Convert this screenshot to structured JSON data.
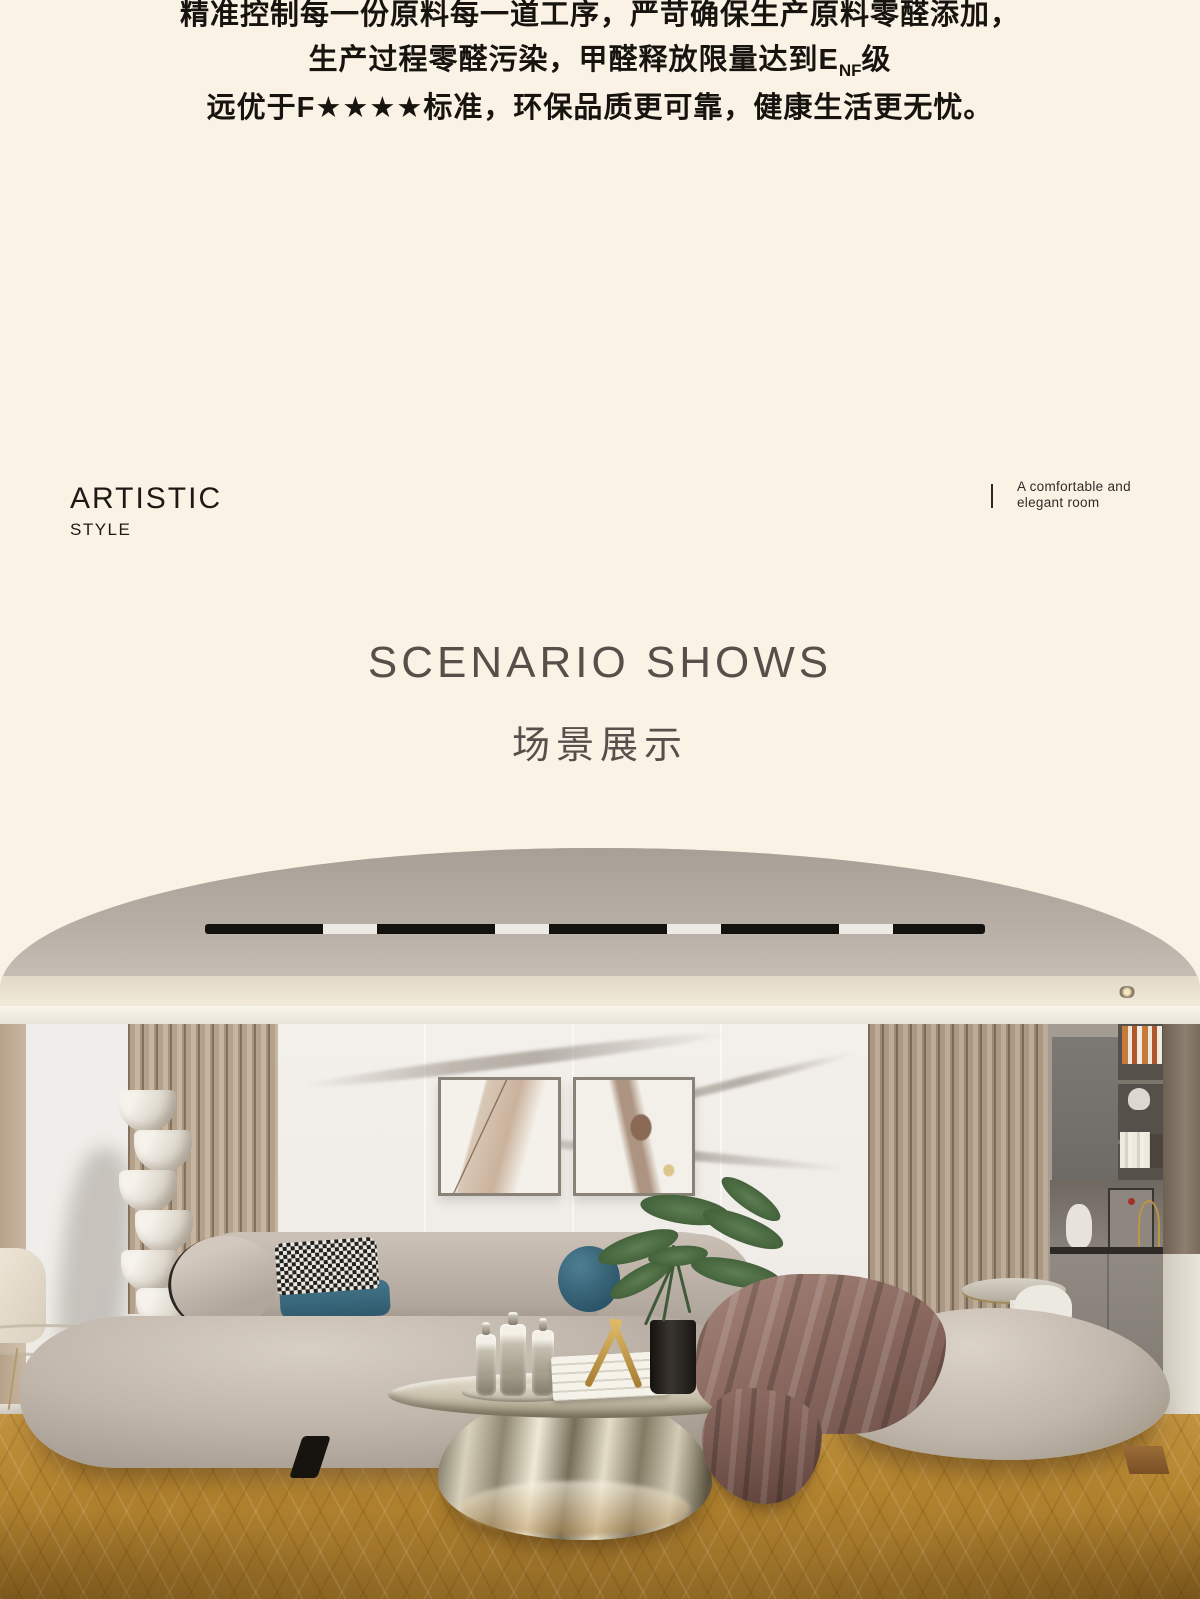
{
  "page": {
    "background": "#faf2e4",
    "width": 1200,
    "height": 1599
  },
  "intro": {
    "line1": "精准控制每一份原料每一道工序，严苛确保生产原料零醛添加，",
    "line2_before": "生产过程零醛污染，甲醛释放限量达到E",
    "line2_sub": "NF",
    "line2_after": "级",
    "line3": "远优于F★★★★标准，环保品质更可靠，健康生活更无忧。"
  },
  "style_block": {
    "title": "ARTISTIC",
    "subtitle": "STYLE"
  },
  "caption": {
    "line1": "A comfortable and",
    "line2": "elegant room"
  },
  "section": {
    "title": "SCENARIO SHOWS",
    "subtitle": "场景展示"
  },
  "palette": {
    "page_background": "#faf2e4",
    "text_dark": "#17140f",
    "heading_gray": "#56504a",
    "ceiling_taupe": "#b3aaa1",
    "cove_cream": "#ece2d0",
    "marble_white": "#f2efeb",
    "slat_wood": "#b3a08c",
    "sofa_greige": "#bdb3a8",
    "pillow_teal": "#3c6c80",
    "throw_mauve": "#8a685e",
    "floor_oak": "#b5862f",
    "chrome_table": "#cfc7b0"
  }
}
